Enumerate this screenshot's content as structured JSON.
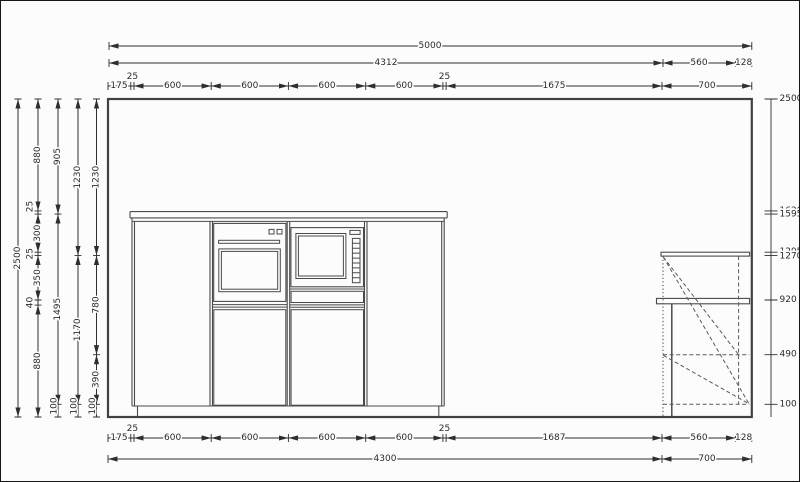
{
  "drawing_title": "kitchen-elevation",
  "colors": {
    "background": "#fcfcfc",
    "line": "#4a4a4a",
    "dimension": "#2e2e2e"
  },
  "dims": {
    "top1": {
      "total": "5000"
    },
    "top2": {
      "d4312": "4312",
      "d560": "560",
      "d128": "128"
    },
    "top3": {
      "d175": "175",
      "d25a": "25",
      "d600a": "600",
      "d600b": "600",
      "d600c": "600",
      "d600d": "600",
      "d25b": "25",
      "d1675": "1675",
      "d700": "700"
    },
    "bottom1": {
      "d175": "175",
      "d25a": "25",
      "d600a": "600",
      "d600b": "600",
      "d600c": "600",
      "d600d": "600",
      "d25b": "25",
      "d1687": "1687",
      "d560": "560",
      "d128": "128"
    },
    "bottom2": {
      "d4300": "4300",
      "d700": "700"
    },
    "left": {
      "c1": {
        "d2500": "2500"
      },
      "c2": {
        "d880a": "880",
        "d25a": "25",
        "d300": "300",
        "d25b": "25",
        "d350": "350",
        "d40": "40",
        "d880b": "880"
      },
      "c3": {
        "d905": "905",
        "d1495": "1495",
        "d100": "100"
      },
      "c4": {
        "d1230": "1230",
        "d1170": "1170",
        "d100": "100"
      },
      "c5": {
        "d1230": "1230",
        "d780": "780",
        "d390": "390",
        "d100": "100"
      }
    },
    "right_ruler": {
      "e2500": "2500",
      "e1620": "1620",
      "e1595": "1595",
      "e1295": "1295",
      "e1270": "1270",
      "e920": "920",
      "e490": "490",
      "e100": "100"
    }
  }
}
